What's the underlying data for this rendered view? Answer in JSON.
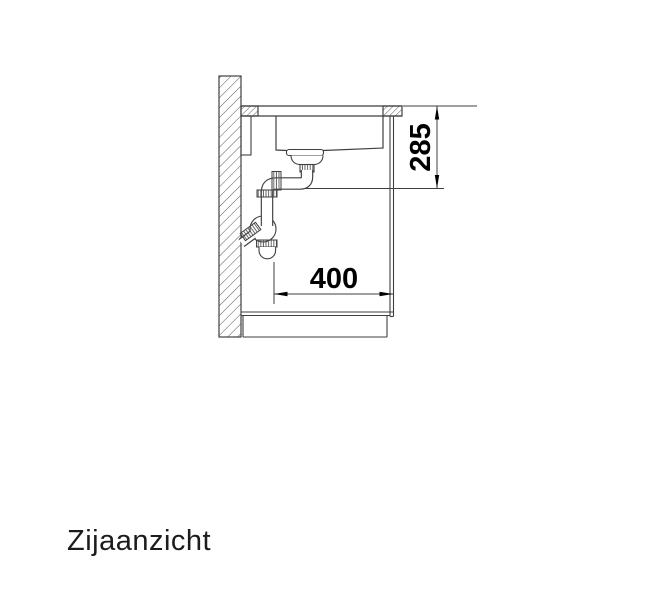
{
  "title": {
    "label": "Zijaanzicht"
  },
  "dimensions": {
    "height": {
      "value": "285"
    },
    "width": {
      "value": "400"
    }
  },
  "colors": {
    "line": "#3f3f3f",
    "hatch": "#5a5a5a",
    "text": "#000000",
    "background": "#ffffff"
  }
}
